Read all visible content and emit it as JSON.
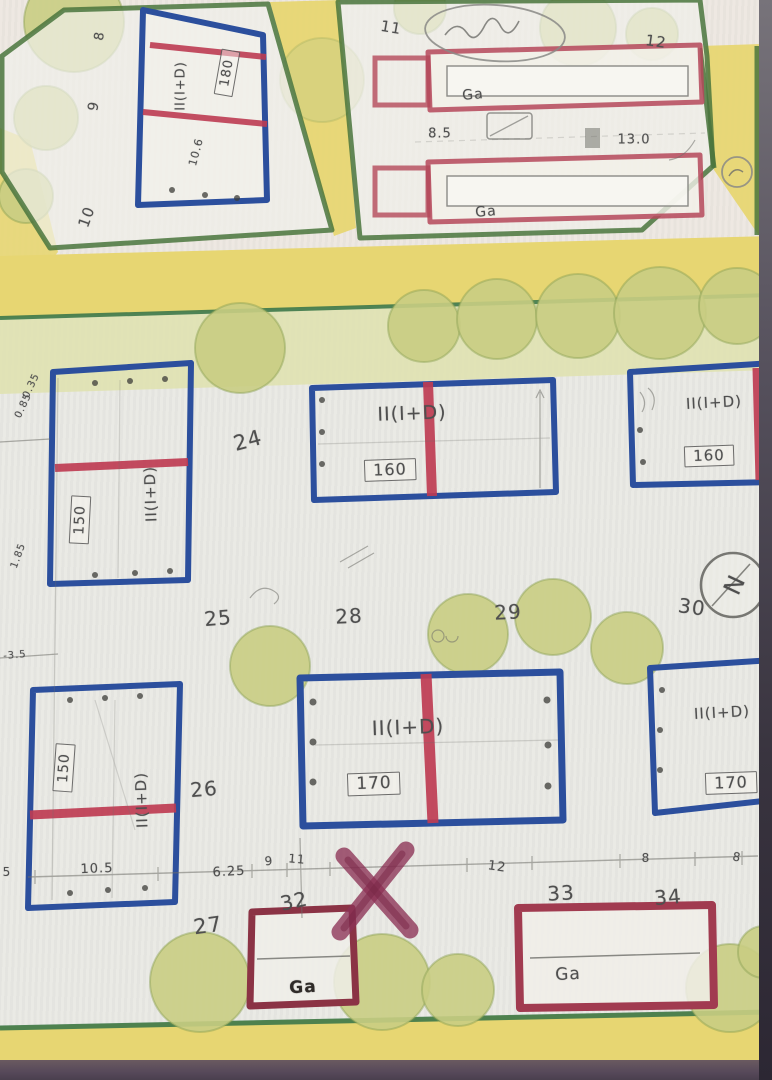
{
  "meta": {
    "description": "Photographed hand-drawn urban site plan with numbered plots, dwellings II(I+D) with floor-area boxes, garages Ga, roads and trees"
  },
  "palette": {
    "paper": "#e9e9e4",
    "paper_top": "#f0ece6",
    "road_yellow": "#e8d66e",
    "road_green_line": "#3c7a49",
    "strip_green": "#dfe2ab",
    "tree_fill": "#c9cd7f",
    "tree_edge": "#8aa04f",
    "plot_green": "#49763b",
    "building_blue": "#2b4fa0",
    "building_red": "#c23b52",
    "garage_red": "#b8475a",
    "garage_dark_red": "#8e3245",
    "pencil": "#4f4f4f",
    "ink": "#2f2b28",
    "x_mark": "#8f3156",
    "photo_edge_dark": "#3f3a44",
    "bottom_purple": "#57495a",
    "stamp_gray": "#8a8a86"
  },
  "compass": {
    "letter": "N"
  },
  "plan": {
    "labels": [
      {
        "name": "plot-number-8",
        "text": "8",
        "x": 100,
        "y": 36,
        "size": 13,
        "rot": -80
      },
      {
        "name": "plot-number-9",
        "text": "9",
        "x": 94,
        "y": 106,
        "size": 14,
        "rot": -80
      },
      {
        "name": "plot-number-10",
        "text": "10",
        "x": 87,
        "y": 217,
        "size": 15,
        "rot": -70
      },
      {
        "name": "dim-10-6",
        "text": "10.6",
        "x": 196,
        "y": 152,
        "size": 11,
        "rot": -75
      },
      {
        "name": "area-box-180",
        "text": "180",
        "x": 227,
        "y": 73,
        "size": 13,
        "rot": -80,
        "boxed": true
      },
      {
        "name": "bldg-type-topleft",
        "text": "II(I+D)",
        "x": 181,
        "y": 86,
        "size": 13,
        "rot": -90
      },
      {
        "name": "plot-number-11",
        "text": "11",
        "x": 391,
        "y": 28,
        "size": 15,
        "rot": 10
      },
      {
        "name": "plot-number-12",
        "text": "12",
        "x": 656,
        "y": 42,
        "size": 15,
        "rot": 8
      },
      {
        "name": "ga-label-top-a",
        "text": "Ga",
        "x": 473,
        "y": 95,
        "size": 14,
        "rot": -5
      },
      {
        "name": "dim-8-5",
        "text": "8.5",
        "x": 440,
        "y": 134,
        "size": 13,
        "rot": 0
      },
      {
        "name": "dim-13-0",
        "text": "13.0",
        "x": 634,
        "y": 140,
        "size": 13,
        "rot": 0
      },
      {
        "name": "ga-label-top-b",
        "text": "Ga",
        "x": 486,
        "y": 212,
        "size": 14,
        "rot": -5
      },
      {
        "name": "dim-0-35",
        "text": "0.35",
        "x": 32,
        "y": 386,
        "size": 10,
        "rot": -65
      },
      {
        "name": "dim-0-85",
        "text": "0.85",
        "x": 24,
        "y": 406,
        "size": 10,
        "rot": -65
      },
      {
        "name": "plot-number-24",
        "text": "24",
        "x": 248,
        "y": 441,
        "size": 21,
        "rot": -15
      },
      {
        "name": "bldg-type-b1",
        "text": "II(I+D)",
        "x": 151,
        "y": 494,
        "size": 15,
        "rot": -92
      },
      {
        "name": "area-box-150-b1",
        "text": "150",
        "x": 80,
        "y": 520,
        "size": 14,
        "rot": -87,
        "boxed": true
      },
      {
        "name": "bldg-type-b2",
        "text": "II(I+D)",
        "x": 412,
        "y": 414,
        "size": 19,
        "rot": -2
      },
      {
        "name": "area-box-160-b2",
        "text": "160",
        "x": 390,
        "y": 470,
        "size": 16,
        "rot": -2,
        "boxed": true
      },
      {
        "name": "bldg-type-b3",
        "text": "II(I+D)",
        "x": 714,
        "y": 403,
        "size": 15,
        "rot": -3
      },
      {
        "name": "area-box-160-b3",
        "text": "160",
        "x": 709,
        "y": 456,
        "size": 15,
        "rot": -2,
        "boxed": true
      },
      {
        "name": "dim-1-85",
        "text": "1.85",
        "x": 19,
        "y": 556,
        "size": 10,
        "rot": -70
      },
      {
        "name": "dim-3-5",
        "text": "-3.5",
        "x": 15,
        "y": 656,
        "size": 10,
        "rot": -5
      },
      {
        "name": "plot-number-25",
        "text": "25",
        "x": 218,
        "y": 618,
        "size": 20,
        "rot": -5
      },
      {
        "name": "plot-number-28",
        "text": "28",
        "x": 349,
        "y": 616,
        "size": 20,
        "rot": -3
      },
      {
        "name": "plot-number-29",
        "text": "29",
        "x": 508,
        "y": 612,
        "size": 20,
        "rot": -3
      },
      {
        "name": "plot-number-30",
        "text": "30",
        "x": 692,
        "y": 607,
        "size": 20,
        "rot": 8
      },
      {
        "name": "compass-letter",
        "text": "N",
        "x": 733,
        "y": 585,
        "size": 24,
        "rot": 115
      },
      {
        "name": "bldg-type-b4",
        "text": "II(I+D)",
        "x": 142,
        "y": 800,
        "size": 15,
        "rot": -92
      },
      {
        "name": "area-box-150-b4",
        "text": "150",
        "x": 64,
        "y": 768,
        "size": 14,
        "rot": -86,
        "boxed": true
      },
      {
        "name": "plot-number-26",
        "text": "26",
        "x": 204,
        "y": 789,
        "size": 20,
        "rot": -5
      },
      {
        "name": "bldg-type-b5",
        "text": "II(I+D)",
        "x": 408,
        "y": 727,
        "size": 20,
        "rot": -2
      },
      {
        "name": "area-box-170-b5",
        "text": "170",
        "x": 374,
        "y": 784,
        "size": 17,
        "rot": -2,
        "boxed": true
      },
      {
        "name": "bldg-type-b6",
        "text": "II(I+D)",
        "x": 722,
        "y": 713,
        "size": 15,
        "rot": -3
      },
      {
        "name": "area-box-170-b6",
        "text": "170",
        "x": 731,
        "y": 783,
        "size": 16,
        "rot": -2,
        "boxed": true
      },
      {
        "name": "dim-5",
        "text": "5",
        "x": 7,
        "y": 872,
        "size": 12,
        "rot": 0
      },
      {
        "name": "dim-10-5",
        "text": "10.5",
        "x": 97,
        "y": 869,
        "size": 13,
        "rot": -2
      },
      {
        "name": "dim-6-25",
        "text": "6.25",
        "x": 229,
        "y": 872,
        "size": 13,
        "rot": -3
      },
      {
        "name": "dim-9",
        "text": "9",
        "x": 269,
        "y": 861,
        "size": 12,
        "rot": -5
      },
      {
        "name": "dim-11",
        "text": "11",
        "x": 297,
        "y": 859,
        "size": 12,
        "rot": 5
      },
      {
        "name": "dim-12",
        "text": "12",
        "x": 497,
        "y": 867,
        "size": 13,
        "rot": 8
      },
      {
        "name": "dim-8-a",
        "text": "8",
        "x": 646,
        "y": 858,
        "size": 12,
        "rot": 0
      },
      {
        "name": "dim-8-b",
        "text": "8",
        "x": 737,
        "y": 857,
        "size": 12,
        "rot": 10
      },
      {
        "name": "plot-number-27",
        "text": "27",
        "x": 208,
        "y": 926,
        "size": 21,
        "rot": -8
      },
      {
        "name": "plot-number-32",
        "text": "32",
        "x": 294,
        "y": 901,
        "size": 20,
        "rot": -12
      },
      {
        "name": "plot-number-33",
        "text": "33",
        "x": 561,
        "y": 893,
        "size": 20,
        "rot": -3
      },
      {
        "name": "plot-number-34",
        "text": "34",
        "x": 668,
        "y": 897,
        "size": 20,
        "rot": -5
      },
      {
        "name": "ga-label-garage-left",
        "text": "Ga",
        "x": 303,
        "y": 988,
        "size": 17,
        "rot": -3,
        "color": "ink"
      },
      {
        "name": "ga-label-garage-right",
        "text": "Ga",
        "x": 568,
        "y": 975,
        "size": 17,
        "rot": -3
      }
    ]
  }
}
